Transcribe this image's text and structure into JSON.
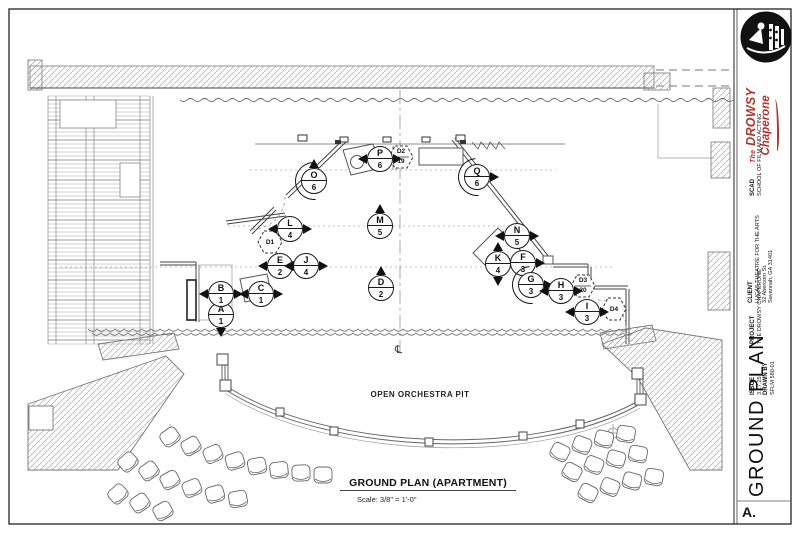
{
  "title_block": {
    "logo": "lucas-theatre-logo",
    "show_the": "The",
    "show_name1": "DROWSY",
    "show_name2": "Chaperone",
    "studio_label": "SCAD",
    "studio_value": "SCHOOL OF FILM AND ACTING",
    "client_label": "CLIENT",
    "client_lines": [
      "LUCAS THEATRE FOR THE ARTS",
      "32 Abercorn St.",
      "Savannah, GA 31401"
    ],
    "project_label": "PROJECT",
    "project_value": "THE DROWSY CHAPERONE",
    "issue_label": "ISSUE",
    "issue_value": "3.17.25",
    "drawn_by_label": "DRAWN BY",
    "drawn_by_value": "SFLM 580-01",
    "sheet_title": "GROUND PLAN",
    "sheet_number": "A."
  },
  "drawing": {
    "caption_title": "GROUND PLAN (APARTMENT)",
    "caption_scale": "Scale:  3/8\" = 1'-0\"",
    "orchestra_pit_label": "OPEN ORCHESTRA PIT",
    "centerline_symbol": "℄"
  },
  "colors": {
    "line": "#333",
    "accent_red": "#b3342a",
    "hatch": "#aaaaaa"
  },
  "markers": [
    {
      "letter": "A",
      "number": "1",
      "x": 221,
      "y": 315,
      "tri": "tb"
    },
    {
      "letter": "B",
      "number": "1",
      "x": 221,
      "y": 294,
      "tri": "lr"
    },
    {
      "letter": "C",
      "number": "1",
      "x": 261,
      "y": 294,
      "tri": "lr"
    },
    {
      "letter": "D",
      "number": "2",
      "x": 381,
      "y": 288,
      "tri": "t"
    },
    {
      "letter": "E",
      "number": "2",
      "x": 280,
      "y": 266,
      "tri": "lr"
    },
    {
      "letter": "F",
      "number": "3",
      "x": 523,
      "y": 263,
      "tri": "lr"
    },
    {
      "letter": "G",
      "number": "3",
      "x": 531,
      "y": 285,
      "tri": "r",
      "rot": true
    },
    {
      "letter": "H",
      "number": "3",
      "x": 561,
      "y": 291,
      "tri": "lr"
    },
    {
      "letter": "I",
      "number": "3",
      "x": 587,
      "y": 312,
      "tri": "lr"
    },
    {
      "letter": "J",
      "number": "4",
      "x": 306,
      "y": 266,
      "tri": "lr"
    },
    {
      "letter": "K",
      "number": "4",
      "x": 498,
      "y": 264,
      "tri": "tb"
    },
    {
      "letter": "L",
      "number": "4",
      "x": 290,
      "y": 229,
      "tri": "lr"
    },
    {
      "letter": "M",
      "number": "5",
      "x": 380,
      "y": 226,
      "tri": "t"
    },
    {
      "letter": "N",
      "number": "5",
      "x": 517,
      "y": 236,
      "tri": "lr"
    },
    {
      "letter": "O",
      "number": "6",
      "x": 314,
      "y": 181,
      "tri": "t",
      "rot": true
    },
    {
      "letter": "P",
      "number": "6",
      "x": 380,
      "y": 159,
      "tri": "lr"
    },
    {
      "letter": "Q",
      "number": "6",
      "x": 477,
      "y": 177,
      "tri": "r",
      "rot": true
    }
  ],
  "hexagons": [
    {
      "label": "D1",
      "x": 270,
      "y": 242
    },
    {
      "label": "D2",
      "number": "19",
      "x": 401,
      "y": 157
    },
    {
      "label": "D3",
      "number": "20",
      "x": 583,
      "y": 286
    },
    {
      "label": "D4",
      "x": 614,
      "y": 309
    }
  ]
}
